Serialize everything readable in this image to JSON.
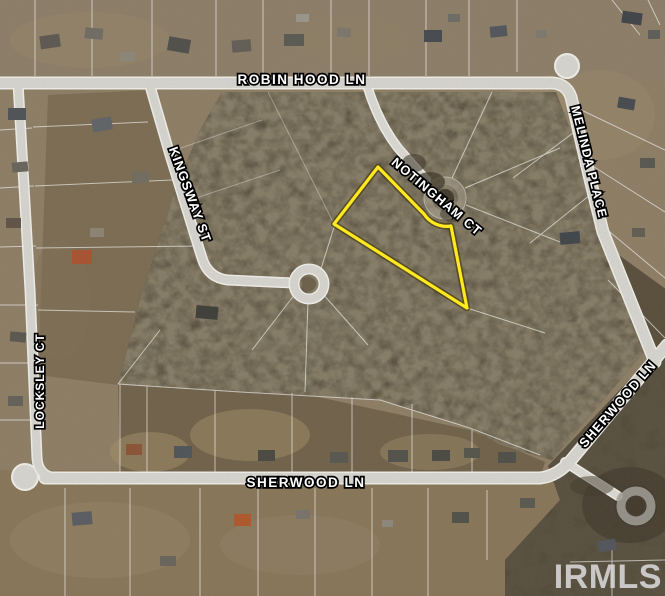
{
  "map": {
    "description": "Aerial parcel map of wooded subdivision with highlighted lot",
    "street_labels": [
      {
        "name": "ROBIN HOOD LN"
      },
      {
        "name": "KINGSWAY ST"
      },
      {
        "name": "NOTINGHAM CT"
      },
      {
        "name": "MELINDA PLACE"
      },
      {
        "name": "LOCKSLEY CT"
      },
      {
        "name": "SHERWOOD LN"
      },
      {
        "name": "SHERWOOD LN"
      }
    ],
    "highlight": {
      "feature": "subject-parcel-outline",
      "color": "#ffe81e"
    },
    "watermark": "IRMLS"
  }
}
